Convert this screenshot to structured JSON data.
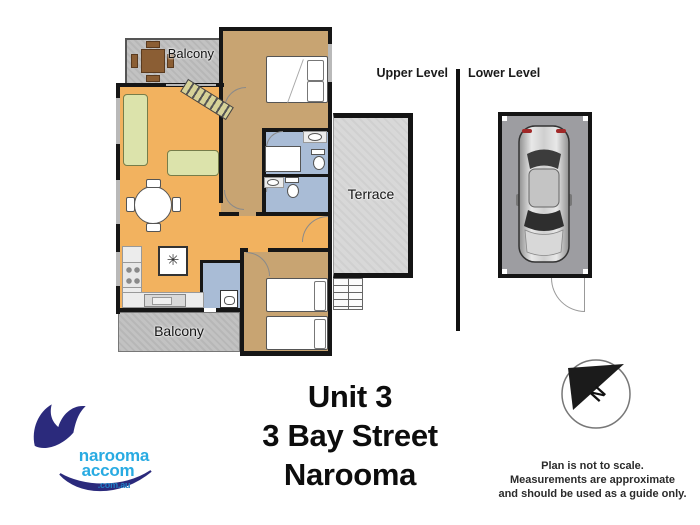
{
  "floorplan": {
    "levels": {
      "upper_label": "Upper Level",
      "lower_label": "Lower Level"
    },
    "rooms": {
      "balcony_top": "Balcony",
      "balcony_bottom": "Balcony",
      "terrace": "Terrace"
    },
    "symbols": {
      "kitchen_star": "✳"
    },
    "colors": {
      "living_floor": "#f2b25f",
      "bedroom_floor": "#c8a472",
      "bathroom_floor": "#a9bcd6",
      "balcony": "#c2c2c2",
      "terrace": "#d8d8d8",
      "garage": "#9d9da1",
      "wall": "#161616",
      "sofa": "#dce3ab",
      "outdoor_table": "#8b5e34",
      "logo_blue": "#29abe2",
      "logo_navy": "#2b2a7c"
    }
  },
  "compass": {
    "north_label": "N"
  },
  "address": {
    "line1": "Unit 3",
    "line2": "3 Bay Street",
    "line3": "Narooma"
  },
  "disclaimer": {
    "line1": "Plan is not to scale.",
    "line2": "Measurements are approximate",
    "line3": "and should be used as a guide only."
  },
  "logo": {
    "name_top": "narooma",
    "name_bottom": "accom",
    "domain": ".com.au"
  }
}
